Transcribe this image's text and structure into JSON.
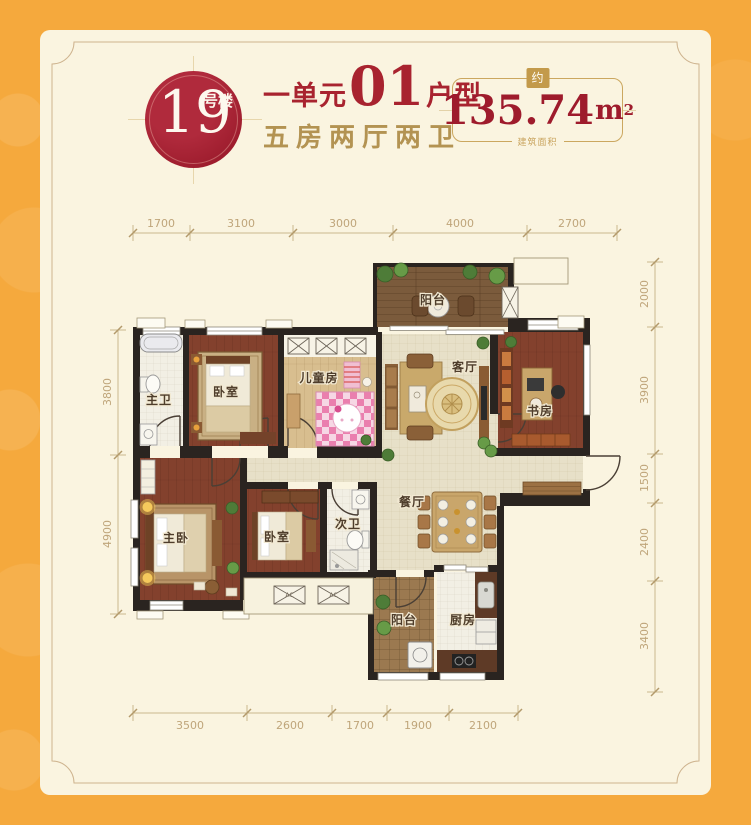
{
  "header": {
    "badge": {
      "number": "19",
      "suffix": "号楼"
    },
    "unit": {
      "prefix": "一单元",
      "number": "01",
      "suffix": "户型"
    },
    "subtitle": "五房两厅两卫",
    "area": {
      "approx": "约",
      "value": "135.74",
      "unit": "m",
      "sup": "2",
      "note": "建筑面积"
    }
  },
  "plan": {
    "rooms": {
      "master_bath": "主卫",
      "bedroom1": "卧室",
      "kids_room": "儿童房",
      "balcony_top": "阳台",
      "living": "客厅",
      "study": "书房",
      "master_bedroom": "主卧",
      "bedroom2": "卧室",
      "second_bath": "次卫",
      "dining": "餐厅",
      "balcony_bottom": "阳台",
      "kitchen": "厨房"
    },
    "dims": {
      "top": [
        "1700",
        "3100",
        "3000",
        "4000",
        "2700"
      ],
      "right": [
        "2000",
        "3900",
        "1500",
        "2400",
        "3400"
      ],
      "left": [
        "3800",
        "4900"
      ],
      "bottom": [
        "3500",
        "2600",
        "1700",
        "1900",
        "2100"
      ]
    },
    "ac_label": "AC"
  },
  "colors": {
    "background_orange": "#F5A93D",
    "card_cream": "#FAF4E0",
    "badge_red": "#9E1D2E",
    "title_red": "#A8232F",
    "gold_text": "#B39352",
    "area_red": "#9E1B2C",
    "dim_text": "#BFA57A"
  }
}
